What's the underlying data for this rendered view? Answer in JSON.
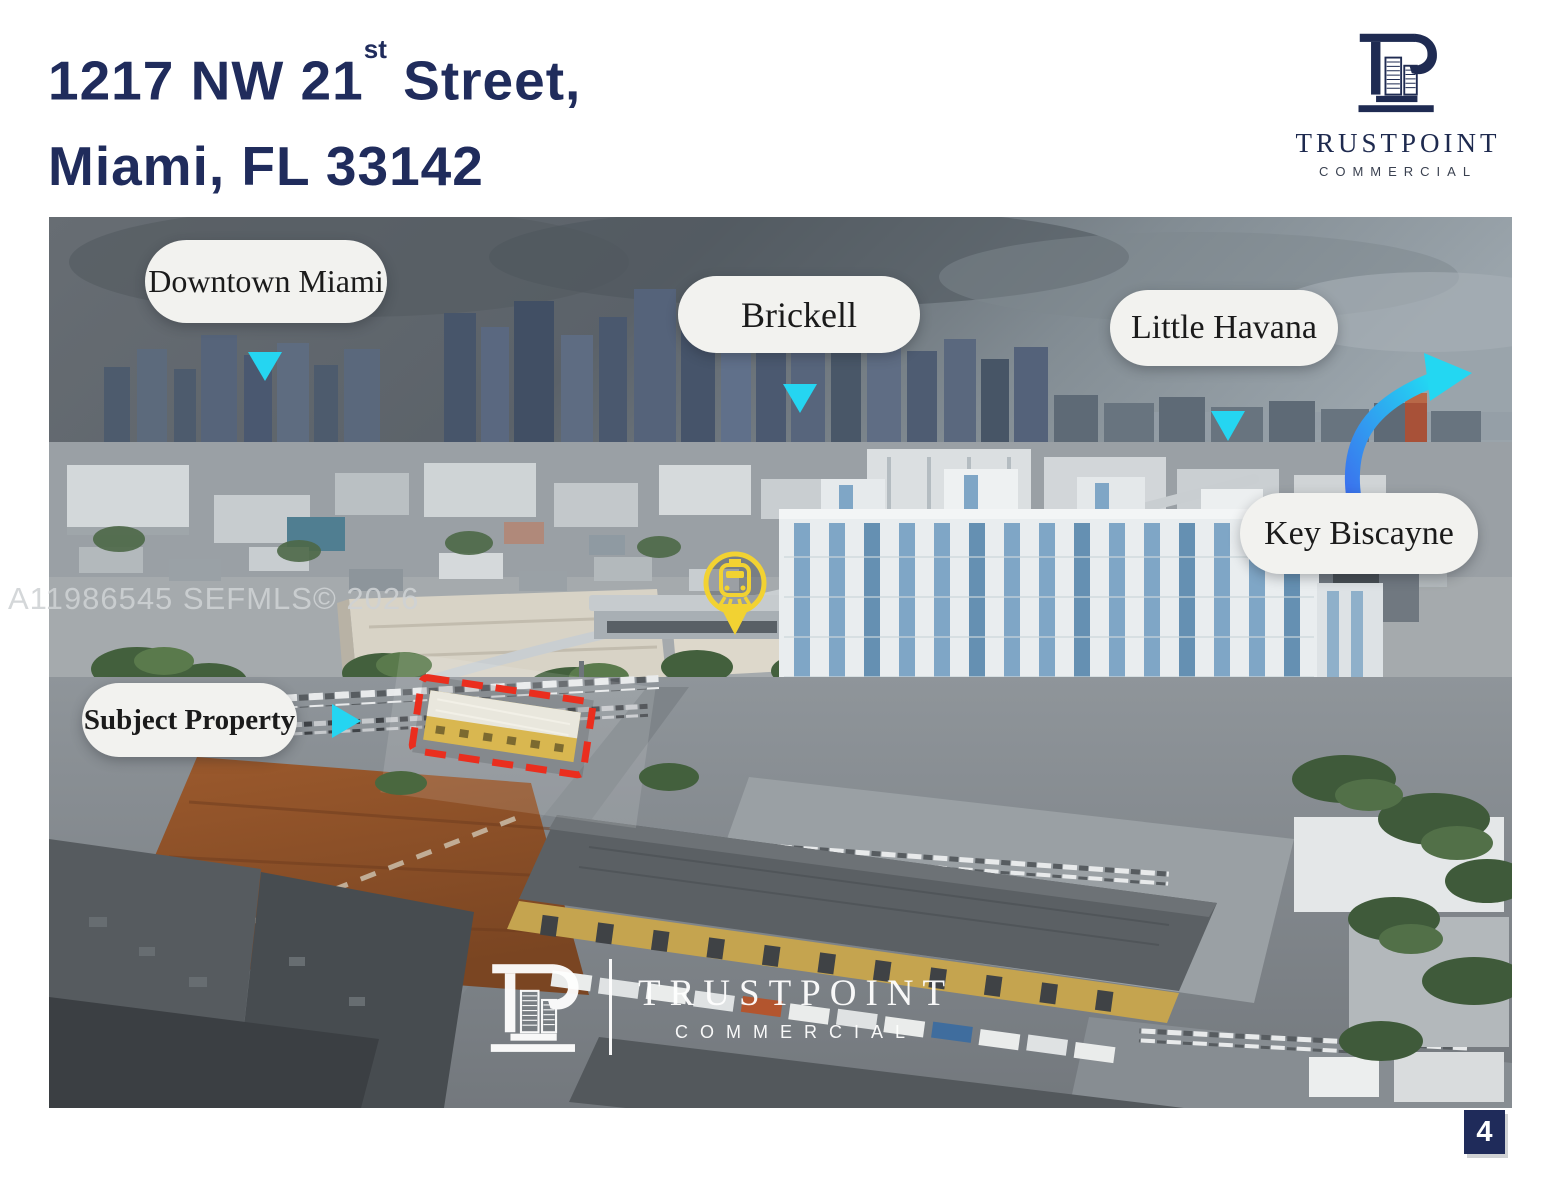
{
  "header": {
    "address_line1": {
      "text": "1217 NW 21",
      "ordinal": "st",
      "suffix": " Street,"
    },
    "address_line2": "Miami, FL 33142"
  },
  "brand": {
    "name": "TRUSTPOINT",
    "division": "COMMERCIAL"
  },
  "photo": {
    "mls_watermark": "A11986545 SEFMLS© 2026",
    "labels": {
      "downtown_miami": "Downtown Miami",
      "brickell": "Brickell",
      "little_havana": "Little Havana",
      "key_biscayne": "Key Biscayne",
      "subject_property": "Subject Property"
    },
    "map_icons": {
      "station_pin": "metrorail-station-pin"
    },
    "center_watermark": {
      "name": "TRUSTPOINT",
      "division": "COMMERCIAL"
    }
  },
  "footer": {
    "page_number": "4"
  },
  "colors": {
    "brand_navy": "#1f2b5a",
    "arrow_blue": "#4a8df0",
    "arrow_cyan": "#23d7f2",
    "highlight_red": "#e93120",
    "station_pin_yellow": "#f2d232",
    "label_pill_bg": "#f2f2ef"
  }
}
